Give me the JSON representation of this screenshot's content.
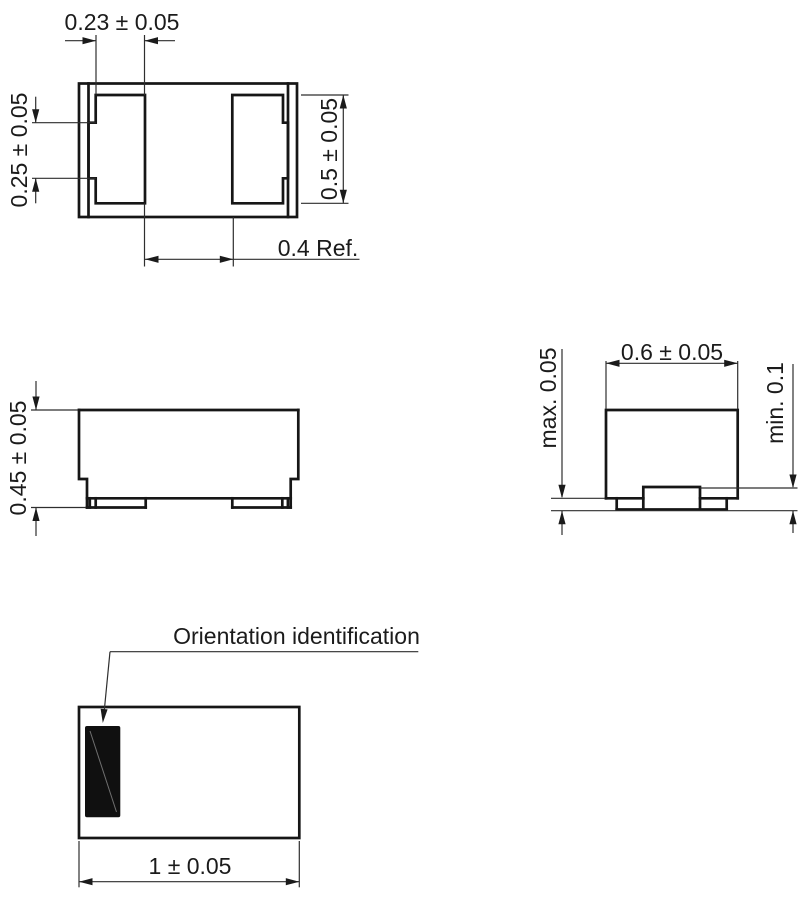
{
  "drawing": {
    "top_view": {
      "terminal_width": "0.23 ± 0.05",
      "terminal_side_width": "0.25 ± 0.05",
      "terminal_length": "0.5 ± 0.05",
      "terminal_gap": "0.4 Ref."
    },
    "side_view": {
      "body_height": "0.45 ± 0.05"
    },
    "end_view": {
      "body_width": "0.6 ± 0.05",
      "standoff": "max. 0.05",
      "terminal_height": "min. 0.1"
    },
    "bottom_view": {
      "callout": "Orientation identification",
      "body_length": "1 ± 0.05"
    },
    "colors": {
      "line": "#1b1b1b",
      "background": "#ffffff",
      "orientation_mark": "#101010"
    }
  }
}
